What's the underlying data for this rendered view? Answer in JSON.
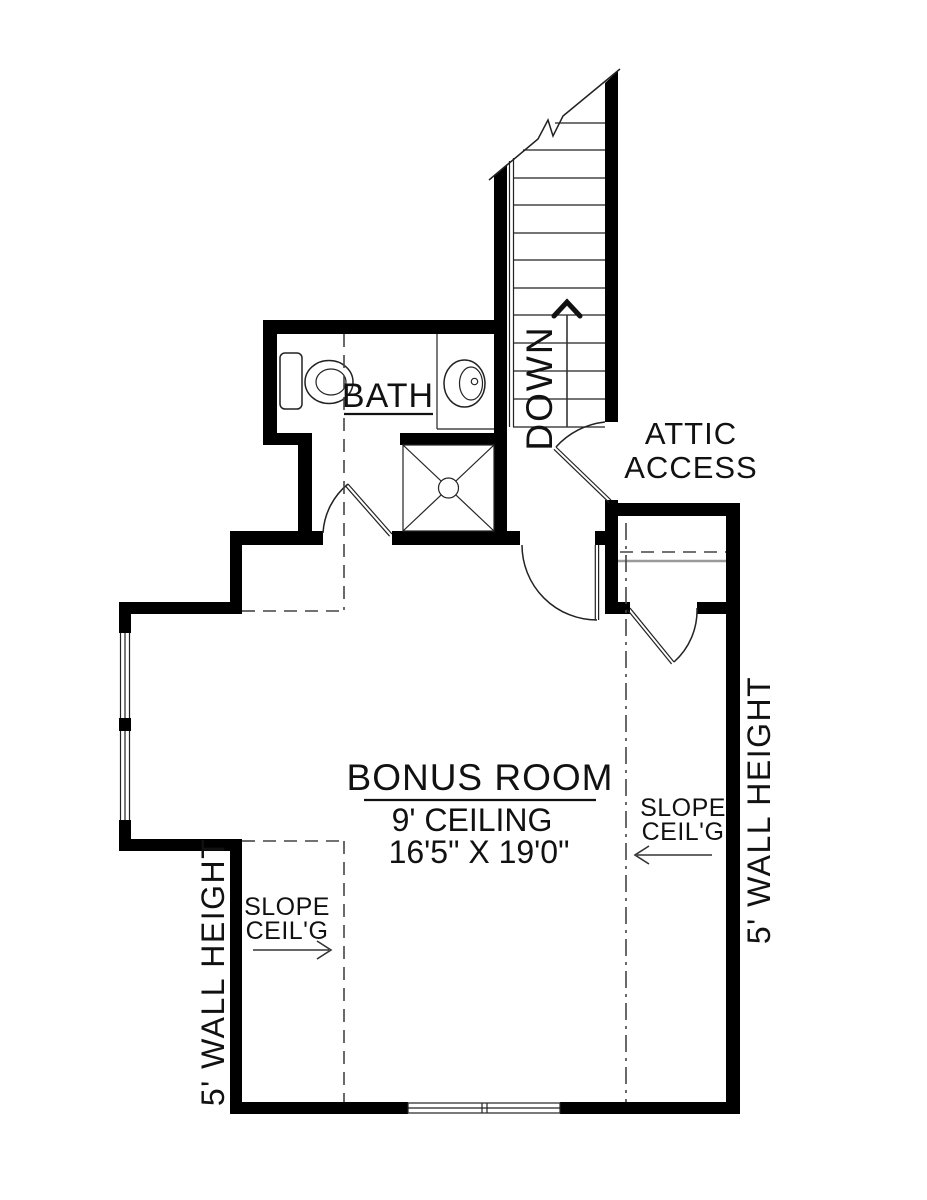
{
  "plan": {
    "rooms": {
      "bonus": {
        "name": "BONUS ROOM",
        "ceiling": "9' CEILING",
        "dimensions": "16'5\" X 19'0\""
      },
      "bath": {
        "name": "BATH"
      }
    },
    "labels": {
      "attic_access_line1": "ATTIC",
      "attic_access_line2": "ACCESS",
      "stair_direction": "DOWN",
      "slope_left_line1": "SLOPE",
      "slope_left_line2": "CEIL'G",
      "slope_right_line1": "SLOPE",
      "slope_right_line2": "CEIL'G",
      "wall_height_left": "5' WALL HEIGHT",
      "wall_height_right": "5' WALL HEIGHT"
    },
    "colors": {
      "wall": "#000000",
      "line": "#222222",
      "dash": "#444444",
      "background": "#ffffff",
      "text": "#111111"
    }
  }
}
